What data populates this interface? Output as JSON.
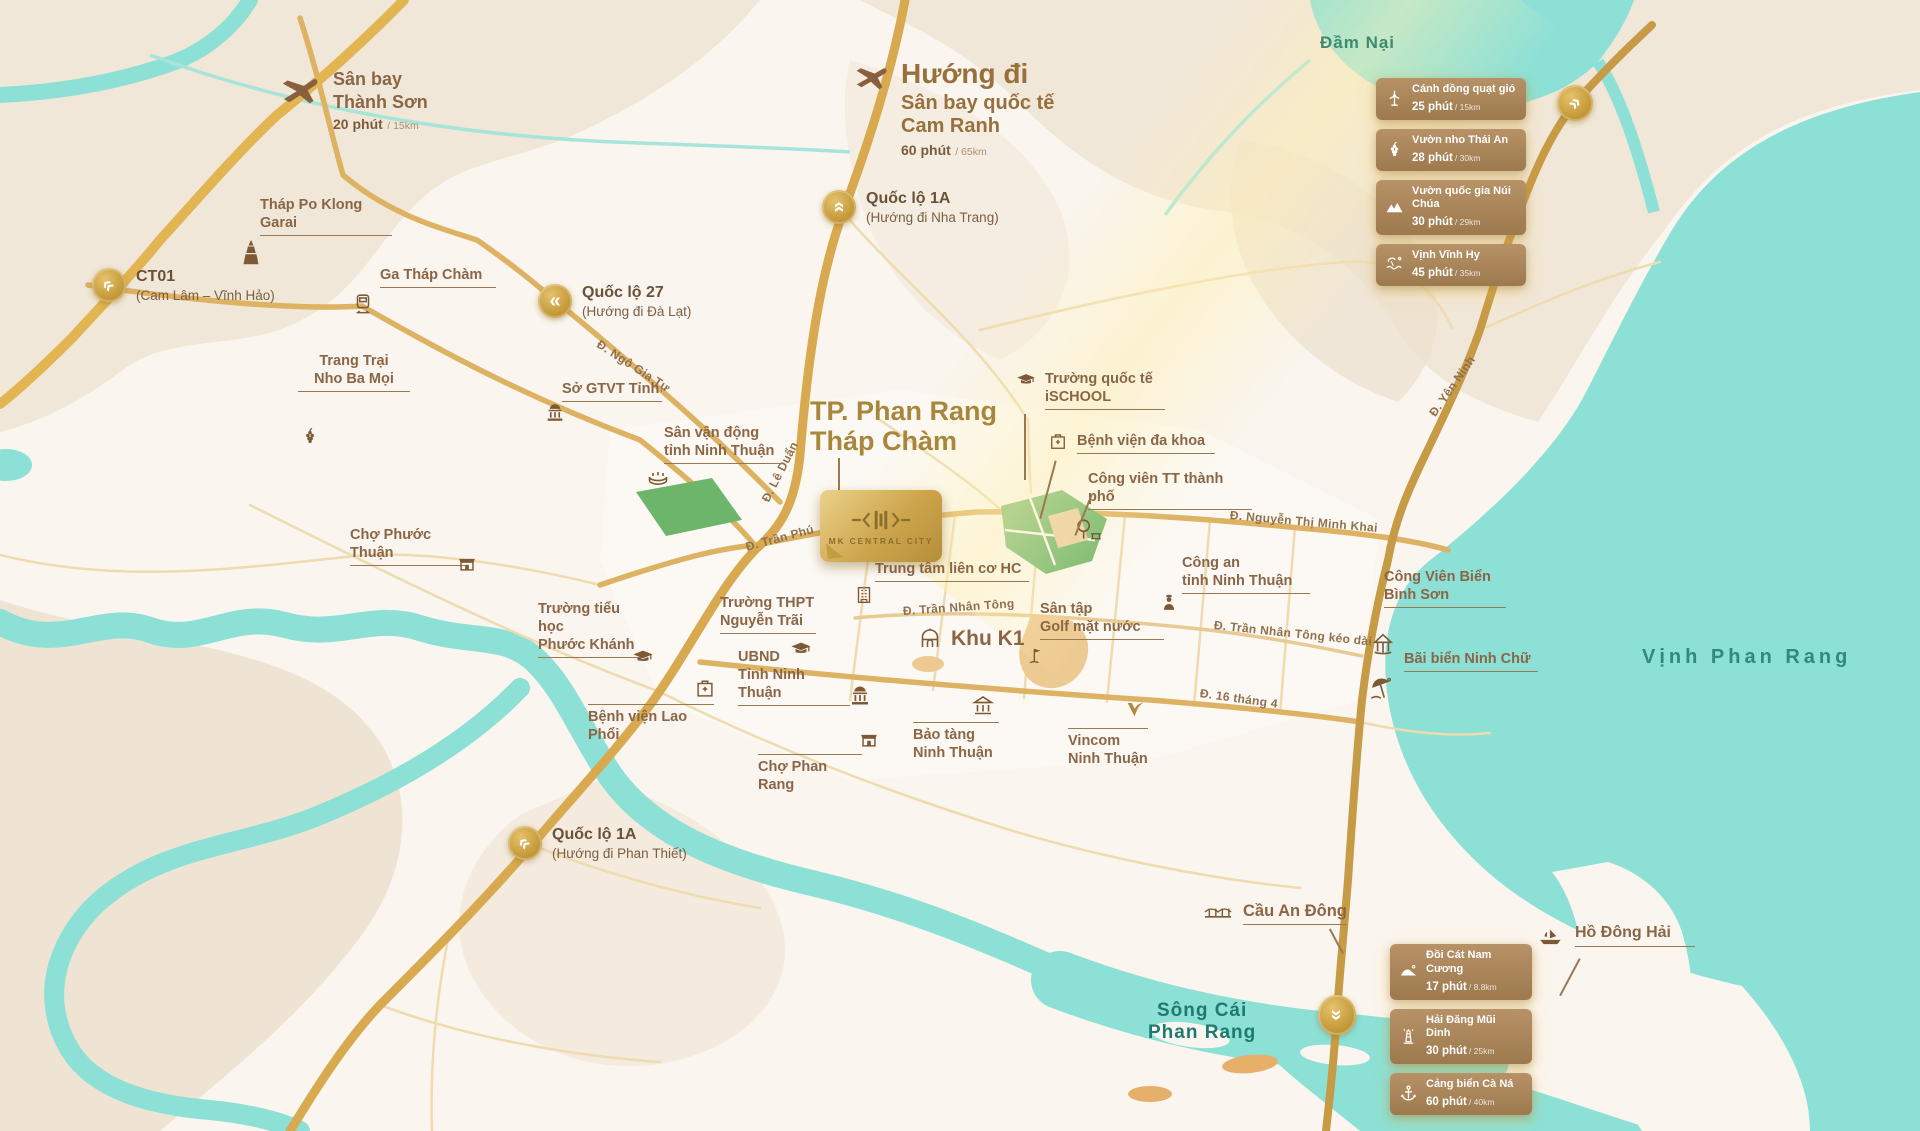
{
  "project": {
    "plaque_label": "MK CENTRAL CITY"
  },
  "city": {
    "title_line1": "TP. Phan Rang",
    "title_line2": "Tháp Chàm"
  },
  "water": {
    "dam_nai": "Đầm Nại",
    "vinh_phan_rang": "Vịnh Phan Rang",
    "song_cai": "Sông Cái\nPhan Rang"
  },
  "airports": {
    "thanh_son": {
      "name": "Sân bay\nThành Sơn",
      "time": "20 phút",
      "dist": "/ 15km"
    },
    "cam_ranh": {
      "prefix": "Hướng đi",
      "name_line1": "Sân bay quốc tế",
      "name_line2": "Cam Ranh",
      "time": "60 phút",
      "dist": "/ 65km"
    }
  },
  "highways": {
    "ct01": {
      "name": "CT01",
      "sub": "(Cam Lâm – Vĩnh Hảo)",
      "icon": "chevron-down-left"
    },
    "ql1a_north": {
      "name": "Quốc lộ 1A",
      "sub": "(Hướng đi Nha Trang)",
      "icon": "chevron-up"
    },
    "ql27": {
      "name": "Quốc lộ 27",
      "sub": "(Hướng đi Đà Lạt)",
      "icon": "chevron-left"
    },
    "ql1a_south": {
      "name": "Quốc lộ 1A",
      "sub": "(Hướng đi Phan Thiết)",
      "icon": "chevron-down-left"
    }
  },
  "roads": {
    "ngo_gia_tu": "Đ. Ngô Gia Tự",
    "le_duan": "Đ. Lê Duẩn",
    "tran_phu": "Đ. Trần Phú",
    "nguyen_thi_minh_khai": "Đ. Nguyễn Thị Minh Khai",
    "tran_nhan_tong": "Đ. Trần Nhân Tông",
    "tran_nhan_tong_keo_dai": "Đ. Trần Nhân Tông kéo dài",
    "thang4_16": "Đ. 16 tháng 4",
    "yen_ninh": "Đ. Yên Ninh"
  },
  "pois": {
    "thap_po_klong_garai": "Tháp Po Klong\nGarai",
    "ga_thap_cham": "Ga Tháp Chàm",
    "trang_trai_nho_ba_moi": "Trang Trại\nNho Ba Mọi",
    "so_gtvt_tinh": "Sở GTVT Tỉnh",
    "san_van_dong": "Sân vận động\ntỉnh Ninh Thuận",
    "truong_quoc_te_ischool": "Trường quốc tế\niSCHOOL",
    "benh_vien_da_khoa": "Bệnh viện đa khoa",
    "cong_vien_tt": "Công viên TT thành phố",
    "trung_tam_lien_co": "Trung tâm liên cơ HC",
    "khu_k1": "Khu K1",
    "san_tap_golf": "Sân tập\nGolf mặt nước",
    "cong_an_tinh": "Công an\ntỉnh Ninh Thuận",
    "cong_vien_bien_binh_son": "Công Viên Biển\nBình Sơn",
    "bai_bien_ninh_chu": "Bãi biển Ninh Chữ",
    "cho_phuoc_thuan": "Chợ Phước Thuận",
    "truong_tieu_hoc": "Trường tiểu học\nPhước Khánh",
    "truong_thpt": "Trường THPT\nNguyễn Trãi",
    "ubnd_tinh": "UBND\nTỉnh Ninh Thuận",
    "benh_vien_lao_phoi": "Bệnh viện Lao Phổi",
    "cho_phan_rang": "Chợ Phan Rang",
    "bao_tang": "Bảo tàng\nNinh Thuận",
    "vincom": "Vincom\nNinh Thuận",
    "cau_an_dong": "Cầu An Đông",
    "ho_dong_hai": "Hồ Đông Hải"
  },
  "destinations_top": [
    {
      "name": "Cánh đồng quạt gió",
      "time": "25 phút",
      "dist": "/ 15km",
      "icon": "windmill"
    },
    {
      "name": "Vườn nho Thái An",
      "time": "28 phút",
      "dist": "/ 30km",
      "icon": "grapes"
    },
    {
      "name": "Vườn quốc gia Núi Chúa",
      "time": "30 phút",
      "dist": "/ 29km",
      "icon": "national-park"
    },
    {
      "name": "Vịnh Vĩnh Hy",
      "time": "45 phút",
      "dist": "/ 35km",
      "icon": "bay"
    }
  ],
  "destinations_bottom": [
    {
      "name": "Đồi Cát Nam Cương",
      "time": "17 phút",
      "dist": "/ 8.8km",
      "icon": "sand-dune"
    },
    {
      "name": "Hải Đăng Mũi Dinh",
      "time": "30 phút",
      "dist": "/ 25km",
      "icon": "lighthouse"
    },
    {
      "name": "Cảng biển Cà Ná",
      "time": "60 phút",
      "dist": "/ 40km",
      "icon": "anchor"
    }
  ],
  "colors": {
    "land": "#faf5ee",
    "terrain": "#f0e6d7",
    "water": "#8ce0d6",
    "road_gold": "#d8ab52",
    "road_minor": "#eedbb0",
    "label_brown": "#8a6647",
    "city_gold": "#a8873c",
    "water_label": "#2f8a7d",
    "badge_bg": "#ad8860",
    "park_green": "#6db56b"
  }
}
